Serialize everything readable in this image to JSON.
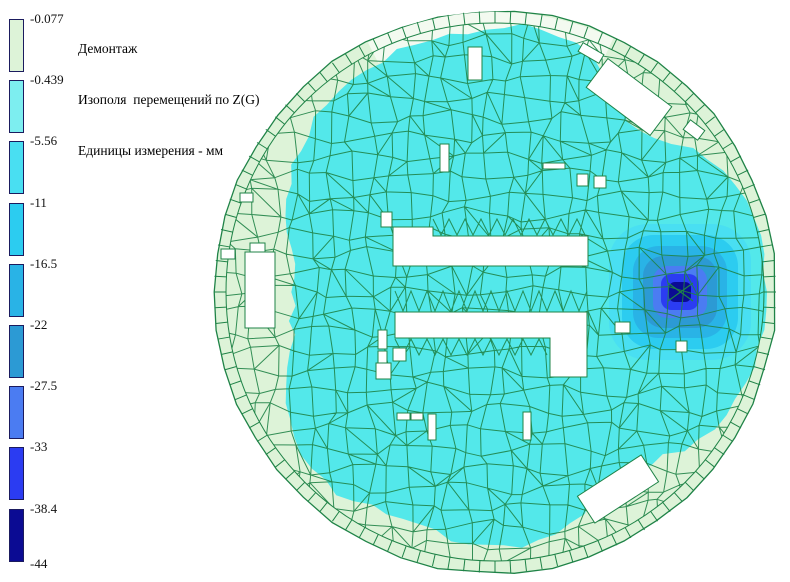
{
  "header": {
    "line1": "Демонтаж",
    "line2": "Изополя  перемещений по Z(G)",
    "line3": "Единицы измерения - мм"
  },
  "legend": {
    "labels": [
      "-0.077",
      "-0.439",
      "-5.56",
      "-11",
      "-16.5",
      "-22",
      "-27.5",
      "-33",
      "-38.4",
      "-44"
    ],
    "band_colors": [
      "#ddf3d8",
      "#7deef0",
      "#49dff2",
      "#2cccf0",
      "#29b3e6",
      "#2c9ad4",
      "#4b7cf2",
      "#2b3cf2",
      "#0b0b93"
    ],
    "border_color": "#1b1b5e"
  },
  "chart_data": {
    "type": "heatmap",
    "title": "Демонтаж",
    "subtitle": "Изополя  перемещений по Z(G)",
    "units": "мм",
    "quantity": "перемещения по Z(G)",
    "scale_thresholds_mm": [
      -0.077,
      -0.439,
      -5.56,
      -11,
      -16.5,
      -22,
      -27.5,
      -33,
      -38.4,
      -44
    ],
    "scale_colors": [
      "#ddf3d8",
      "#7deef0",
      "#49dff2",
      "#2cccf0",
      "#29b3e6",
      "#2c9ad4",
      "#4b7cf2",
      "#2b3cf2",
      "#0b0b93"
    ],
    "field_summary": {
      "dominant_band_mm": "-0.439 to -5.56",
      "edge_band_mm": "-0.077 to -0.439",
      "min_value_mm": -44,
      "min_location": "local hotspot right of slab center",
      "max_value_mm": -0.077
    },
    "geometry": {
      "canvas": [
        790,
        582
      ],
      "center": [
        495,
        292
      ],
      "radius": 281,
      "ring_width": 12,
      "ring_ticks": 112,
      "outer_facets": 46,
      "grid_step": 19.5,
      "field_color": "#53e8ea",
      "pale_color": "#ddf3d8",
      "rim_white_color": "#f3faf0",
      "mesh_color": "#1f8347",
      "pale_gap_profile": [
        [
          0,
          10
        ],
        [
          14,
          13
        ],
        [
          28,
          20
        ],
        [
          42,
          40
        ],
        [
          52,
          58
        ],
        [
          60,
          62
        ],
        [
          70,
          42
        ],
        [
          82,
          24
        ],
        [
          92,
          24
        ],
        [
          104,
          36
        ],
        [
          116,
          34
        ],
        [
          128,
          26
        ],
        [
          140,
          30
        ],
        [
          152,
          46
        ],
        [
          164,
          68
        ],
        [
          176,
          82
        ],
        [
          188,
          76
        ],
        [
          200,
          55
        ],
        [
          212,
          42
        ],
        [
          224,
          30
        ],
        [
          236,
          27
        ],
        [
          248,
          20
        ],
        [
          260,
          21
        ],
        [
          270,
          18
        ],
        [
          280,
          14
        ],
        [
          290,
          24
        ],
        [
          300,
          45
        ],
        [
          308,
          66
        ],
        [
          316,
          56
        ],
        [
          326,
          34
        ],
        [
          338,
          18
        ],
        [
          350,
          11
        ],
        [
          360,
          10
        ]
      ],
      "white_rim_arc_deg": [
        243,
        295
      ],
      "hotspot": {
        "center": [
          680,
          292
        ],
        "half_sizes": [
          [
            71,
            68
          ],
          [
            58,
            57
          ],
          [
            47,
            46
          ],
          [
            37,
            36
          ],
          [
            27,
            26
          ],
          [
            19,
            18
          ],
          [
            11,
            10
          ]
        ],
        "band_color_indices": [
          2,
          3,
          4,
          5,
          6,
          7,
          8
        ]
      },
      "rect_holes": [
        [
          468,
          47,
          14,
          33
        ],
        [
          440,
          144,
          9,
          28
        ],
        [
          543,
          163,
          22,
          6
        ],
        [
          577,
          174,
          11,
          12
        ],
        [
          594,
          176,
          12,
          12
        ],
        [
          381,
          212,
          11,
          15
        ],
        [
          245,
          252,
          30,
          76
        ],
        [
          250,
          243,
          15,
          9
        ],
        [
          240,
          193,
          13,
          9
        ],
        [
          221,
          249,
          14,
          10
        ],
        [
          378,
          330,
          9,
          19
        ],
        [
          378,
          351,
          9,
          17
        ],
        [
          393,
          348,
          13,
          13
        ],
        [
          376,
          363,
          15,
          16
        ],
        [
          397,
          413,
          13,
          7
        ],
        [
          411,
          413,
          12,
          7
        ],
        [
          428,
          414,
          8,
          26
        ],
        [
          523,
          412,
          8,
          28
        ],
        [
          615,
          322,
          15,
          11
        ],
        [
          676,
          341,
          11,
          11
        ]
      ],
      "rot_holes": [
        [
          629,
          97,
          80,
          36,
          37
        ],
        [
          694,
          130,
          18,
          12,
          37
        ],
        [
          591,
          53,
          24,
          10,
          30
        ],
        [
          618,
          489,
          76,
          32,
          -33
        ]
      ],
      "poly_holes": [
        [
          [
            393,
            227
          ],
          [
            433,
            227
          ],
          [
            433,
            236
          ],
          [
            588,
            236
          ],
          [
            588,
            266
          ],
          [
            393,
            266
          ]
        ],
        [
          [
            395,
            312
          ],
          [
            587,
            312
          ],
          [
            587,
            377
          ],
          [
            550,
            377
          ],
          [
            550,
            338
          ],
          [
            395,
            338
          ]
        ]
      ],
      "zigzag_strips": [
        [
          433,
          588,
          219,
          235
        ],
        [
          395,
          587,
          291,
          311
        ],
        [
          395,
          550,
          339,
          355
        ]
      ]
    }
  }
}
